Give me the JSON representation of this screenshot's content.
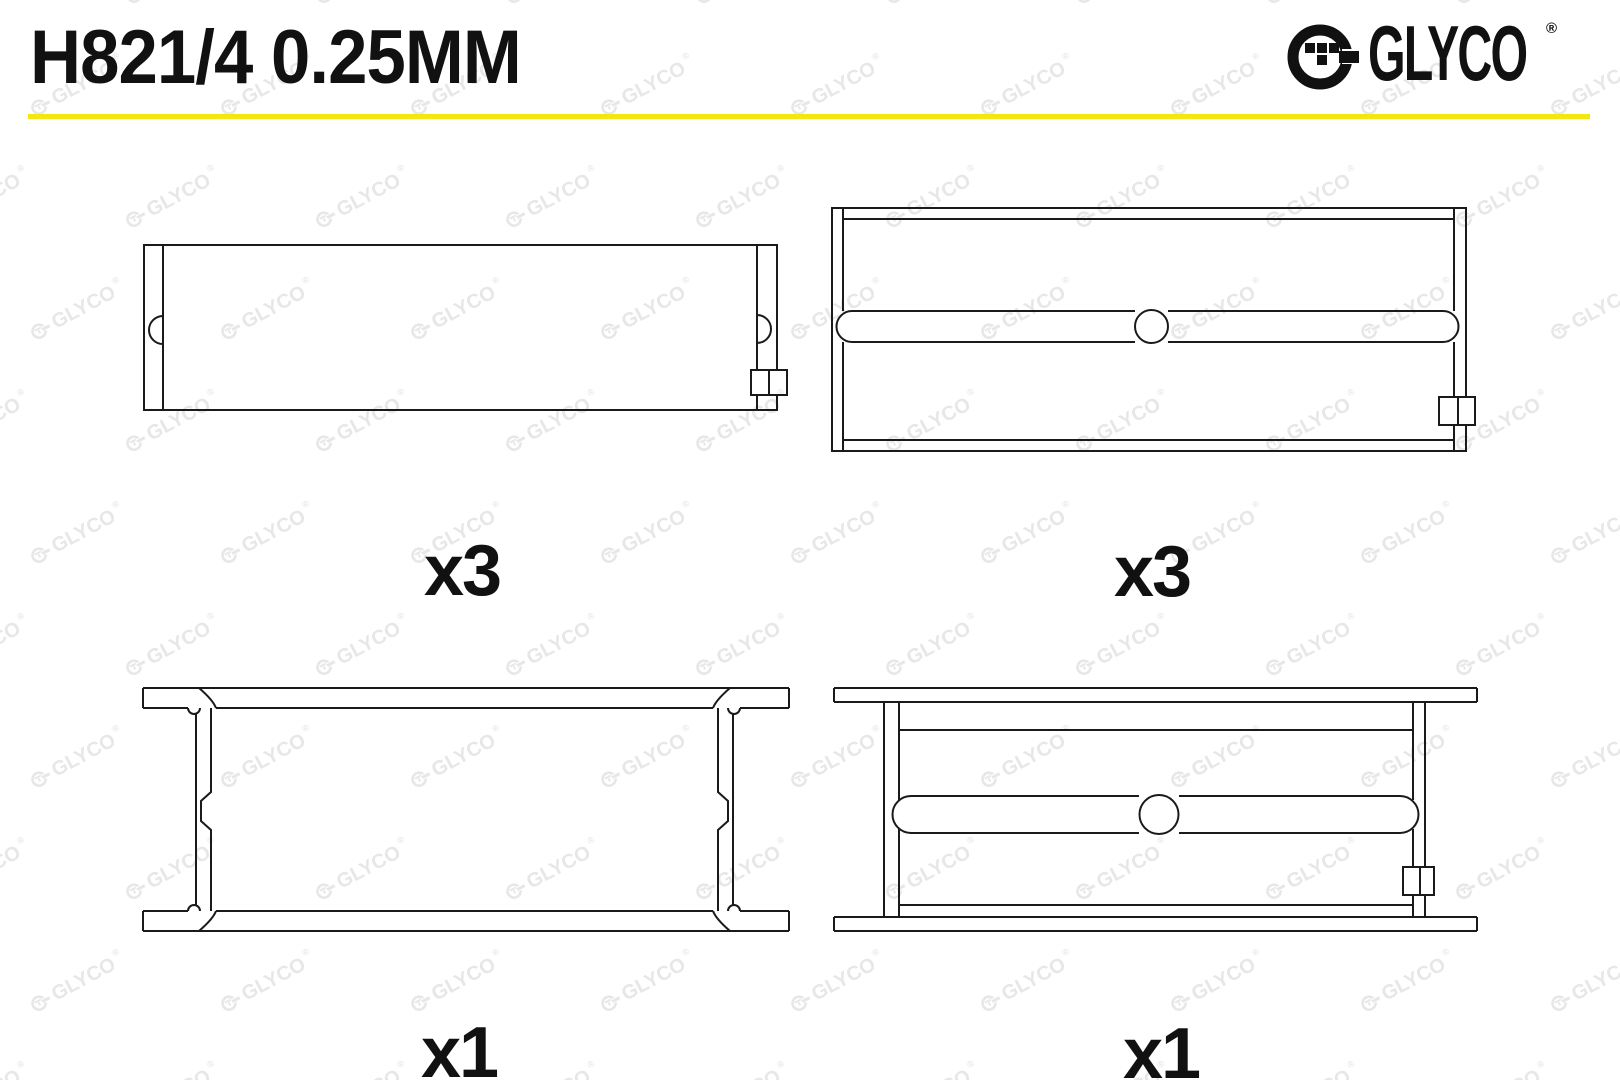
{
  "header": {
    "part_number": "H821/4 0.25MM",
    "accent_color": "#F2E70E",
    "brand": {
      "name": "GLYCO",
      "registered": "®"
    }
  },
  "figures": [
    {
      "id": "upper-shell-plain",
      "quantity_label": "x3"
    },
    {
      "id": "upper-shell-oil-groove",
      "quantity_label": "x3"
    },
    {
      "id": "flanged-shell-plain",
      "quantity_label": "x1"
    },
    {
      "id": "flanged-shell-oil-groove",
      "quantity_label": "x1"
    }
  ],
  "watermark": {
    "text": "GLYCO",
    "registered": "®",
    "color": "#e7e7e7",
    "rotation_deg": -28,
    "cols": 10,
    "rows": 11,
    "col_spacing": 190,
    "row_spacing": 112,
    "row_offset": 95,
    "x0": -70,
    "y0": -36
  }
}
